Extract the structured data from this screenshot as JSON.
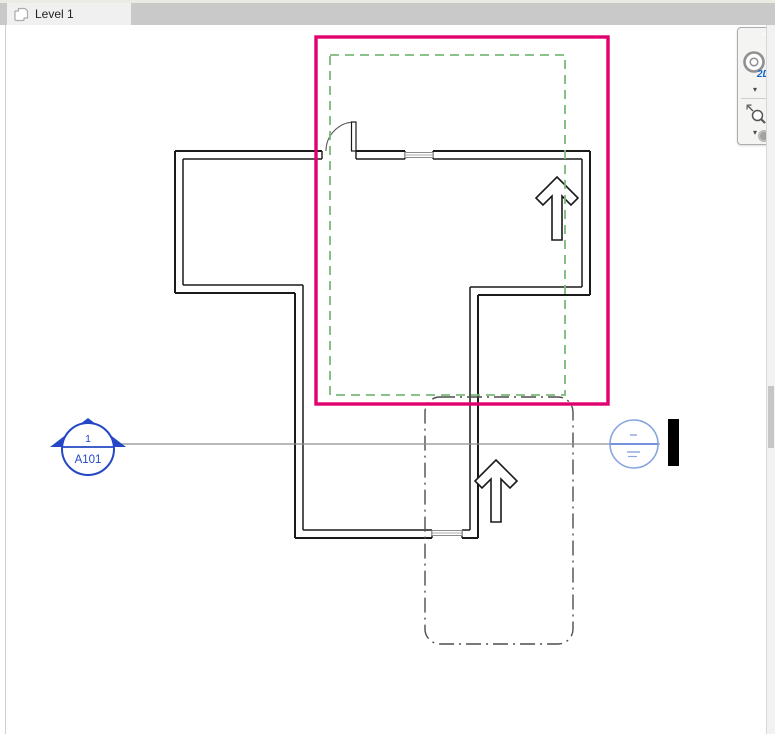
{
  "tab_bar": {
    "tabs": [
      {
        "label": "Level 1",
        "active": true
      }
    ]
  },
  "plan": {
    "view_name": "Level 1",
    "section_marker": {
      "detail_number": "1",
      "sheet_number": "A101"
    },
    "section_tail": {
      "reference_top": "-",
      "reference_bottom": "-"
    }
  },
  "navigation_bar": {
    "wheel_label": "2D"
  },
  "icons": {
    "chevron_down": "▾",
    "close_glyph": "✕"
  },
  "colors": {
    "crop_region": "#e0006e",
    "annotation_crop": "#7ab97a",
    "scope_box": "#4d4d4d",
    "wall": "#1a1a1a",
    "section_line": "#8f8f8f",
    "section_head_blue": "#2447c5",
    "section_tail_blue": "#8ba5de",
    "section_tail_line": "#4a6fd0"
  }
}
